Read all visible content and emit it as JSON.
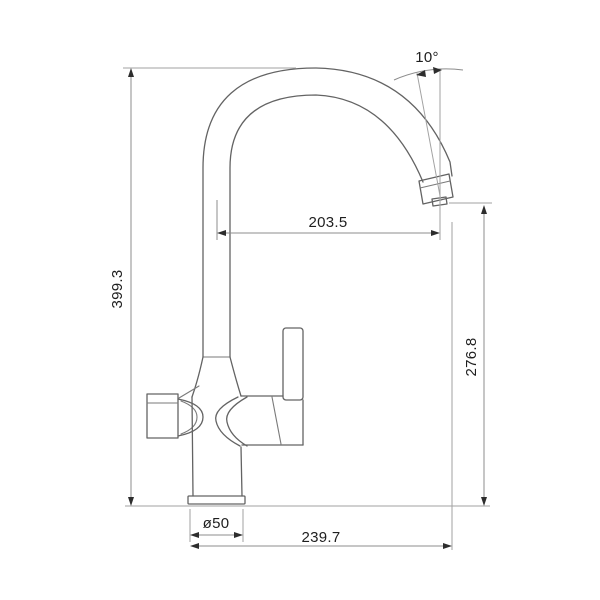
{
  "drawing": {
    "kind": "faucet-dimension-drawing",
    "colors": {
      "background": "#ffffff",
      "object_line": "#636363",
      "extension_line": "#a2a2a2",
      "dimension_line": "#8c8c8c",
      "arrow": "#2d2d2d",
      "text": "#1e1e1e"
    },
    "labels": {
      "overall_height": "399.3",
      "spout_reach": "203.5",
      "spout_outlet_height": "276.8",
      "base_diameter": "ø50",
      "overall_depth": "239.7",
      "spout_angle": "10°"
    }
  }
}
